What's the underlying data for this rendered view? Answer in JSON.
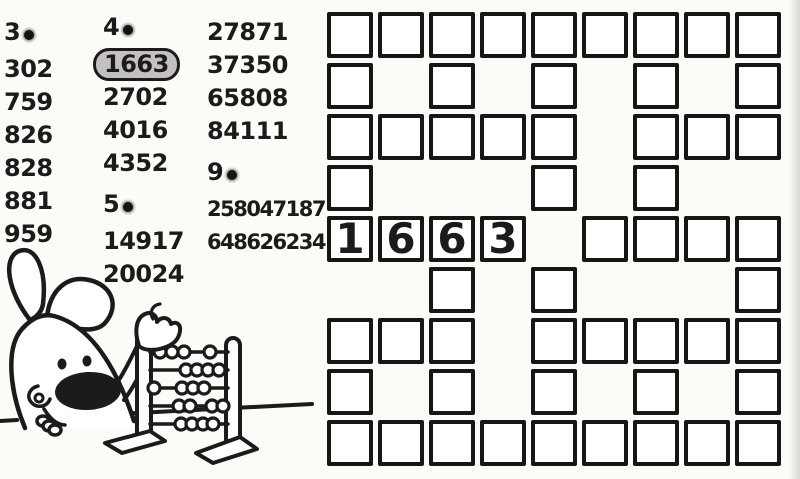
{
  "colors": {
    "ink": "#1b1b1b",
    "paper": "#fbfbf8",
    "highlight_fill": "#c3bfc3",
    "cell_fill": "#fffffe"
  },
  "lists": {
    "columns": [
      {
        "name": "column-1",
        "entries": [
          {
            "kind": "header",
            "text": "3"
          },
          {
            "kind": "number",
            "text": "302"
          },
          {
            "kind": "number",
            "text": "759"
          },
          {
            "kind": "number",
            "text": "826"
          },
          {
            "kind": "number",
            "text": "828"
          },
          {
            "kind": "number",
            "text": "881"
          },
          {
            "kind": "number",
            "text": "959"
          }
        ]
      },
      {
        "name": "column-2",
        "entries": [
          {
            "kind": "header",
            "text": "4"
          },
          {
            "kind": "number",
            "text": "1663",
            "highlighted": true
          },
          {
            "kind": "number",
            "text": "2702"
          },
          {
            "kind": "number",
            "text": "4016"
          },
          {
            "kind": "number",
            "text": "4352"
          },
          {
            "kind": "header",
            "text": "5"
          },
          {
            "kind": "number",
            "text": "14917"
          },
          {
            "kind": "number",
            "text": "20024"
          }
        ]
      },
      {
        "name": "column-3",
        "entries": [
          {
            "kind": "number",
            "text": "27871"
          },
          {
            "kind": "number",
            "text": "37350"
          },
          {
            "kind": "number",
            "text": "65808"
          },
          {
            "kind": "number",
            "text": "84111"
          },
          {
            "kind": "header",
            "text": "9"
          },
          {
            "kind": "number",
            "text": "258047187"
          },
          {
            "kind": "number",
            "text": "648626234"
          }
        ]
      }
    ]
  },
  "grid": {
    "rows": [
      "111111111",
      "101010101",
      "111110111",
      "100010100",
      "111101111",
      "001010001",
      "111011111",
      "101010101",
      "111111111"
    ],
    "prefilled": [
      {
        "row": 5,
        "col": 1,
        "digit": "1"
      },
      {
        "row": 5,
        "col": 2,
        "digit": "6"
      },
      {
        "row": 5,
        "col": 3,
        "digit": "6"
      },
      {
        "row": 5,
        "col": 4,
        "digit": "3"
      }
    ]
  },
  "illustration": {
    "name": "rabbit-with-abacus"
  }
}
